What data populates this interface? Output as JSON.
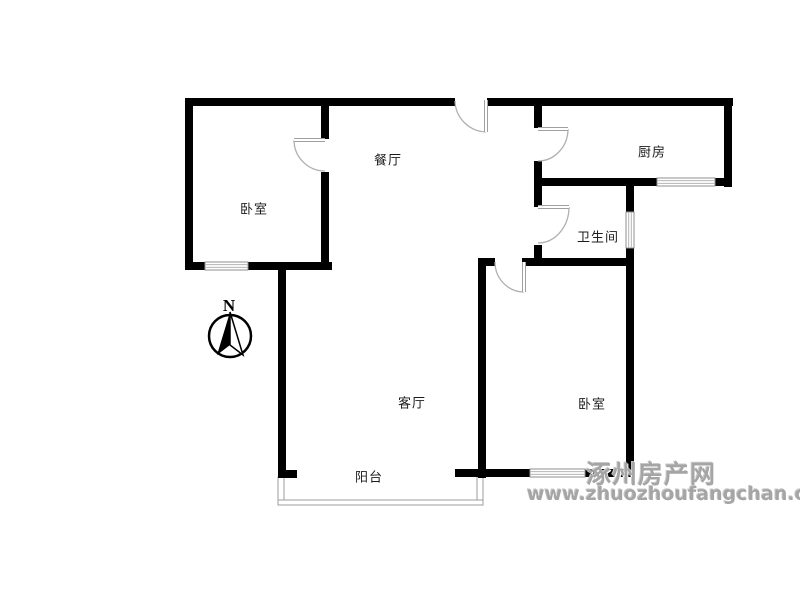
{
  "page": {
    "type": "floor-plan",
    "background": "#ffffff"
  },
  "rooms": [
    {
      "id": "bedroom-left",
      "label": "卧室",
      "cx": 254,
      "cy": 208
    },
    {
      "id": "dining",
      "label": "餐厅",
      "cx": 388,
      "cy": 159
    },
    {
      "id": "kitchen",
      "label": "厨房",
      "cx": 652,
      "cy": 151
    },
    {
      "id": "bathroom",
      "label": "卫生间",
      "cx": 598,
      "cy": 236
    },
    {
      "id": "living",
      "label": "客厅",
      "cx": 412,
      "cy": 402
    },
    {
      "id": "bedroom-right",
      "label": "卧室",
      "cx": 592,
      "cy": 403
    },
    {
      "id": "balcony",
      "label": "阳台",
      "cx": 369,
      "cy": 476
    }
  ],
  "compass": {
    "label": "N"
  },
  "watermark": {
    "line1": "涿州房产网",
    "line2": "www.zhuozhoufangchan.com",
    "color": "#a5a5a5"
  },
  "plan": {
    "colors": {
      "wall": "#000000",
      "window_border": "#8f8f8f",
      "window_line": "#b5b5b5",
      "door_arc": "#b0b0b0",
      "door_leaf": "#a0a0a0",
      "balcony_rail": "#9c9c9c"
    },
    "walls": [
      [
        185,
        98,
        270,
        8
      ],
      [
        487,
        98,
        246,
        8
      ],
      [
        185,
        98,
        8,
        172
      ],
      [
        185,
        262,
        20,
        8
      ],
      [
        248,
        262,
        84,
        8
      ],
      [
        321,
        98,
        8,
        41
      ],
      [
        321,
        172,
        8,
        98
      ],
      [
        278,
        263,
        8,
        215
      ],
      [
        278,
        470,
        19,
        8
      ],
      [
        534,
        98,
        8,
        30
      ],
      [
        534,
        161,
        8,
        46
      ],
      [
        534,
        245,
        8,
        21
      ],
      [
        724,
        98,
        8,
        89
      ],
      [
        534,
        178,
        123,
        8
      ],
      [
        715,
        178,
        17,
        8
      ],
      [
        626,
        186,
        8,
        26
      ],
      [
        626,
        248,
        8,
        229
      ],
      [
        478,
        258,
        17,
        8
      ],
      [
        522,
        258,
        112,
        8
      ],
      [
        478,
        258,
        8,
        220
      ],
      [
        455,
        469,
        75,
        8
      ],
      [
        585,
        469,
        49,
        8
      ]
    ],
    "windows": [
      {
        "rect": [
          205,
          262,
          43,
          8
        ],
        "o": "h"
      },
      {
        "rect": [
          657,
          178,
          58,
          8
        ],
        "o": "h"
      },
      {
        "rect": [
          626,
          212,
          8,
          36
        ],
        "o": "v"
      },
      {
        "rect": [
          530,
          469,
          55,
          8
        ],
        "o": "h"
      }
    ],
    "doors": [
      {
        "leaf": [
          325,
          140,
          294,
          140
        ],
        "arc": "M294,140 A31,31 0 0 0 325,171"
      },
      {
        "leaf": [
          486,
          100,
          486,
          132
        ],
        "arc": "M455,101 A32,32 0 0 0 486,132"
      },
      {
        "leaf": [
          538,
          129,
          568,
          129
        ],
        "arc": "M568,129 A30,32 0 0 1 538,161"
      },
      {
        "leaf": [
          538,
          207,
          569,
          207
        ],
        "arc": "M569,207 A31,36 0 0 1 538,243"
      },
      {
        "leaf": [
          524,
          262,
          524,
          292
        ],
        "arc": "M495,262 A29,30 0 0 0 524,292"
      }
    ],
    "balcony_rails": [
      [
        278,
        477,
        6,
        28
      ],
      [
        477,
        477,
        6,
        28
      ],
      [
        278,
        500,
        205,
        5
      ]
    ],
    "compass_geometry": {
      "circle": [
        230,
        336,
        21
      ],
      "needle_dark": "230,312 217,355 230,345",
      "needle_light": "230,312 243,355 230,345",
      "label_pos": [
        229,
        311
      ]
    }
  }
}
